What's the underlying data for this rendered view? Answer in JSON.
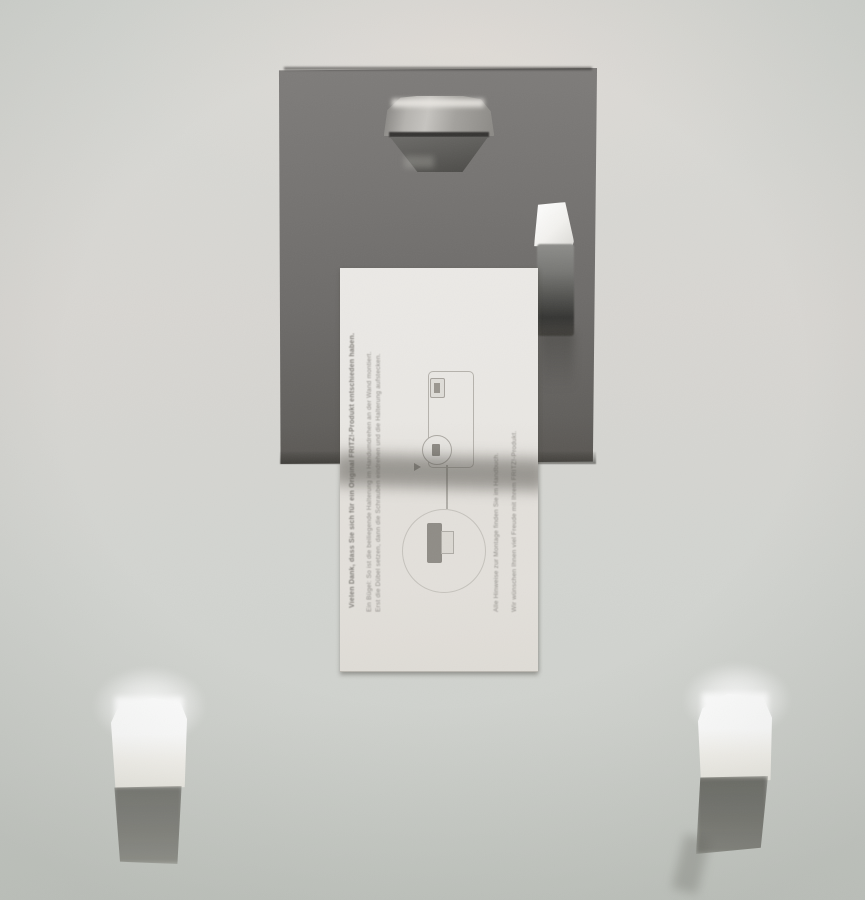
{
  "meta": {
    "type": "photograph",
    "subject": "Back side of a wall-mounted device holder: dark gray cardboard panel with a metal hanger hook and a metal spring clip, a white instruction card (rotated 90 degrees, fine German print and connection diagrams) tucked under the clip, and two small white foam blocks stuck to the wall below, each catching bright light and casting a dark shadow."
  },
  "colors": {
    "wall": "#d6d8d3",
    "board": "#6f6d6b",
    "board_edge": "#55534f",
    "hook_metal_light": "#c6c4c0",
    "hook_metal_dark": "#4a4946",
    "clip_highlight": "#f4f4f2",
    "clip_dark": "#3a3a38",
    "card": "#e8e6e2",
    "card_ink": "#8f8c87",
    "foam": "#ffffff",
    "foam_shadow": "#6e6e69"
  },
  "card": {
    "orientation_note": "card printed landscape, photographed rotated 90° counter-clockwise; fine print is blurred and illegible in the photo (German text, approximated)",
    "text_lines": [
      "Vielen Dank, dass Sie sich für ein Original FRITZ!-Produkt entschieden haben.",
      "Ein Bügel: So ist die beiliegende Halterung im Handumdrehen an der Wand montiert.",
      "Erst die Dübel setzen, dann die Schrauben eindrehen und die Halterung aufstecken.",
      "Alle Hinweise zur Montage finden Sie im Handbuch.",
      "Wir wünschen Ihnen viel Freude mit Ihrem FRITZ!-Produkt."
    ]
  }
}
